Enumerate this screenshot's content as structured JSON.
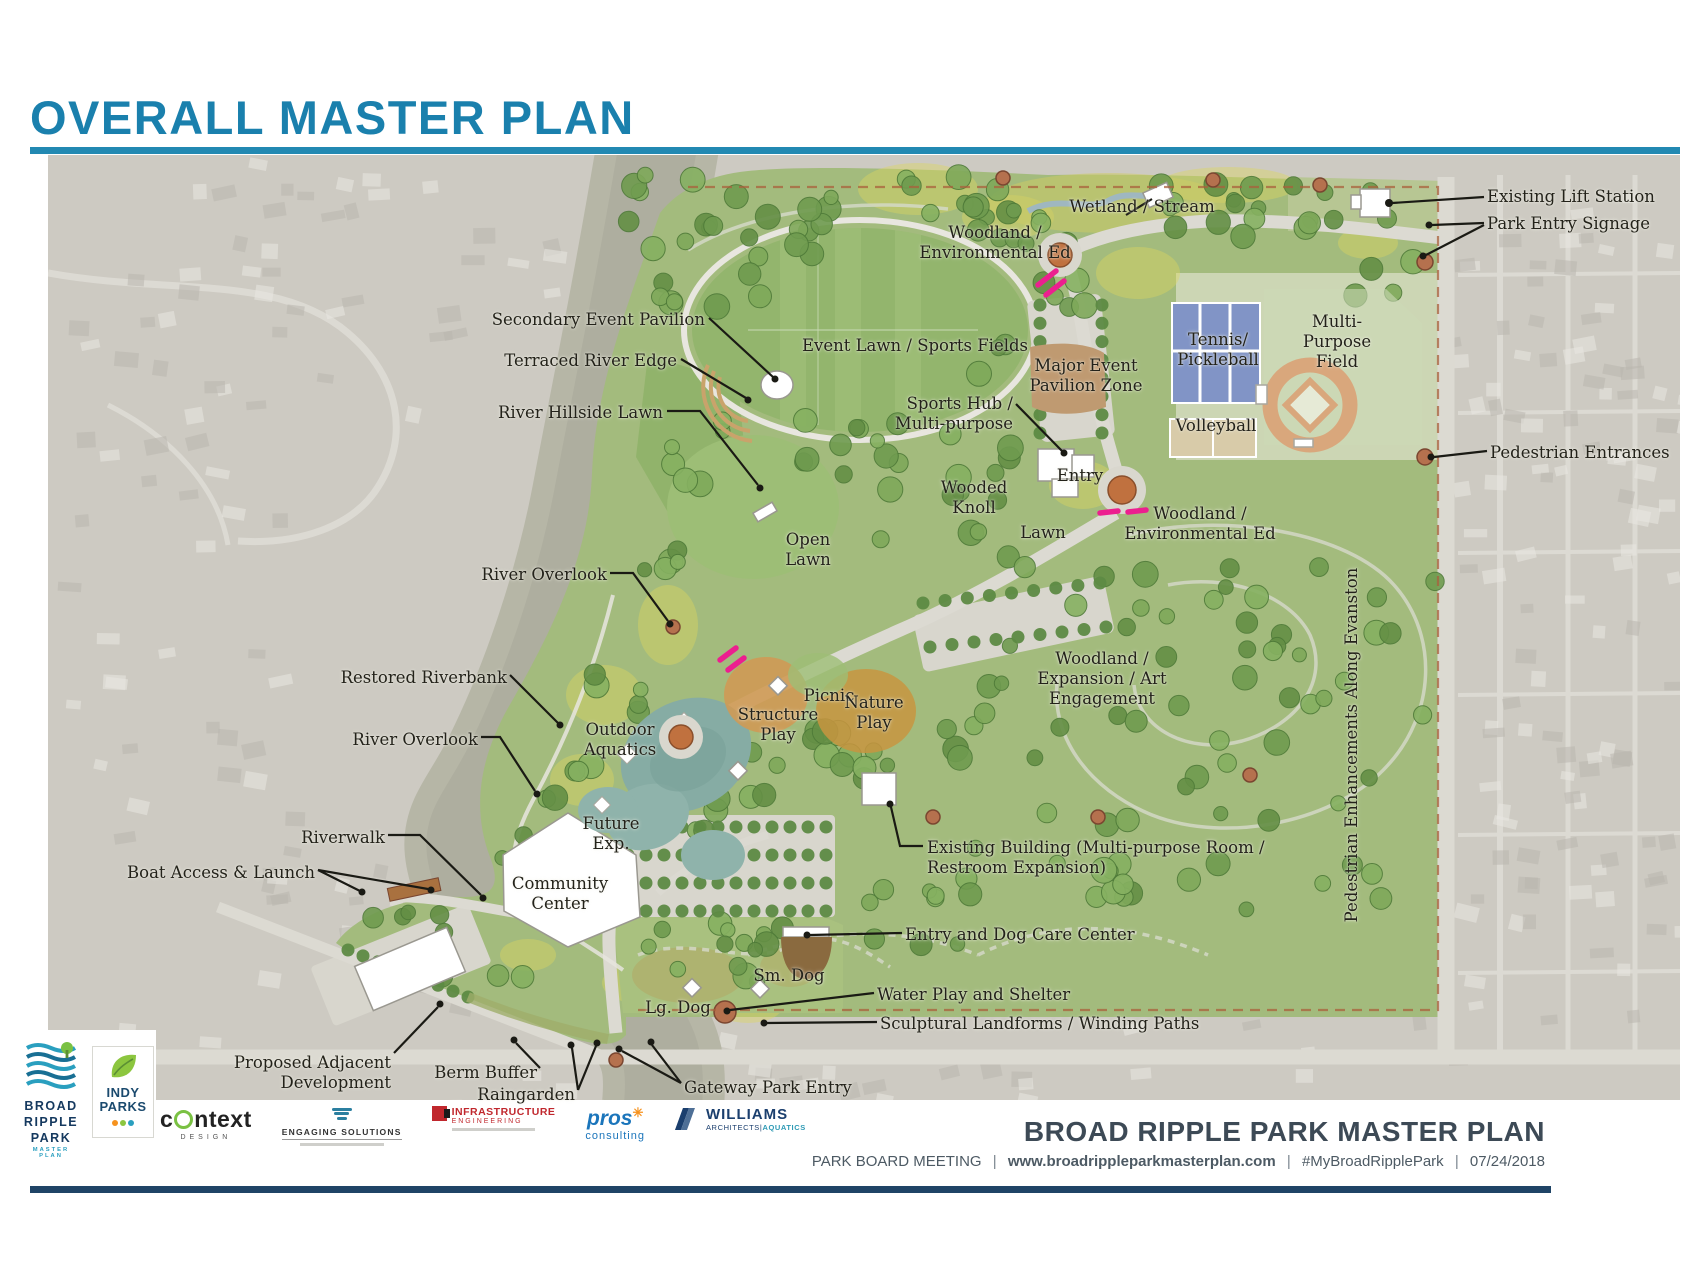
{
  "page": {
    "title": "OVERALL MASTER PLAN"
  },
  "colors": {
    "title": "#1a80ad",
    "rule": "#2289b2",
    "footer_navy": "#1f4466",
    "label_ink": "#23221a",
    "gateway_magenta": "#ec1f8f",
    "park_green": "#a3bb7d",
    "river_gray_green": "#b6b6a6",
    "entry_node_rust": "#b5714e",
    "court_blue": "#8194c6"
  },
  "map": {
    "labels": [
      {
        "id": "existing-lift-station",
        "text": "Existing Lift Station",
        "x": 1439,
        "y": 32,
        "align": "left"
      },
      {
        "id": "park-entry-signage",
        "text": "Park Entry Signage",
        "x": 1439,
        "y": 59,
        "align": "left"
      },
      {
        "id": "wetland-stream",
        "text": "Wetland / Stream",
        "x": 1094,
        "y": 42,
        "align": "center"
      },
      {
        "id": "woodland-env-ed-north",
        "text": "Woodland /\nEnvironmental Ed",
        "x": 947,
        "y": 68,
        "align": "center"
      },
      {
        "id": "secondary-event-pavilion",
        "text": "Secondary Event Pavilion",
        "x": 657,
        "y": 155,
        "align": "right"
      },
      {
        "id": "terraced-river-edge",
        "text": "Terraced River Edge",
        "x": 629,
        "y": 196,
        "align": "right"
      },
      {
        "id": "river-hillside-lawn",
        "text": "River Hillside Lawn",
        "x": 615,
        "y": 248,
        "align": "right"
      },
      {
        "id": "event-lawn-sports-fields",
        "text": "Event Lawn / Sports Fields",
        "x": 867,
        "y": 181,
        "align": "center"
      },
      {
        "id": "major-event-pavilion-zone",
        "text": "Major Event\nPavilion Zone",
        "x": 1038,
        "y": 201,
        "align": "center"
      },
      {
        "id": "sports-hub",
        "text": "Sports Hub /\nMulti-purpose",
        "x": 965,
        "y": 239,
        "align": "right"
      },
      {
        "id": "tennis-pickleball",
        "text": "Tennis/\nPickleball",
        "x": 1170,
        "y": 175,
        "align": "center"
      },
      {
        "id": "volleyball",
        "text": "Volleyball",
        "x": 1168,
        "y": 261,
        "align": "center"
      },
      {
        "id": "multi-purpose-field",
        "text": "Multi-\nPurpose\nField",
        "x": 1289,
        "y": 157,
        "align": "center"
      },
      {
        "id": "entry",
        "text": "Entry",
        "x": 1032,
        "y": 311,
        "align": "center"
      },
      {
        "id": "wooded-knoll",
        "text": "Wooded\nKnoll",
        "x": 926,
        "y": 323,
        "align": "center"
      },
      {
        "id": "lawn",
        "text": "Lawn",
        "x": 995,
        "y": 368,
        "align": "center"
      },
      {
        "id": "woodland-env-ed-east",
        "text": "Woodland /\nEnvironmental Ed",
        "x": 1152,
        "y": 349,
        "align": "center"
      },
      {
        "id": "pedestrian-entrances",
        "text": "Pedestrian Entrances",
        "x": 1442,
        "y": 288,
        "align": "left"
      },
      {
        "id": "river-overlook-north",
        "text": "River Overlook",
        "x": 559,
        "y": 410,
        "align": "right"
      },
      {
        "id": "open-lawn",
        "text": "Open\nLawn",
        "x": 760,
        "y": 375,
        "align": "center"
      },
      {
        "id": "restored-riverbank",
        "text": "Restored Riverbank",
        "x": 459,
        "y": 513,
        "align": "right"
      },
      {
        "id": "river-overlook-south",
        "text": "River Overlook",
        "x": 430,
        "y": 575,
        "align": "right"
      },
      {
        "id": "outdoor-aquatics",
        "text": "Outdoor\nAquatics",
        "x": 572,
        "y": 565,
        "align": "center"
      },
      {
        "id": "structure-play",
        "text": "Structure\nPlay",
        "x": 730,
        "y": 550,
        "align": "center"
      },
      {
        "id": "picnic",
        "text": "Picnic",
        "x": 781,
        "y": 531,
        "align": "center"
      },
      {
        "id": "nature-play",
        "text": "Nature\nPlay",
        "x": 826,
        "y": 538,
        "align": "center"
      },
      {
        "id": "woodland-expansion-art",
        "text": "Woodland /\nExpansion / Art\nEngagement",
        "x": 1054,
        "y": 494,
        "align": "center"
      },
      {
        "id": "riverwalk",
        "text": "Riverwalk",
        "x": 337,
        "y": 673,
        "align": "right"
      },
      {
        "id": "boat-access-launch",
        "text": "Boat Access & Launch",
        "x": 267,
        "y": 708,
        "align": "right"
      },
      {
        "id": "community-center",
        "text": "Community\nCenter",
        "x": 512,
        "y": 719,
        "align": "center"
      },
      {
        "id": "future-exp",
        "text": "Future\nExp.",
        "x": 563,
        "y": 659,
        "align": "center"
      },
      {
        "id": "existing-building",
        "text": "Existing Building (Multi-purpose Room /\nRestroom Expansion)",
        "x": 879,
        "y": 683,
        "align": "left"
      },
      {
        "id": "entry-dog-care",
        "text": "Entry and Dog Care Center",
        "x": 857,
        "y": 770,
        "align": "left"
      },
      {
        "id": "sm-dog",
        "text": "Sm. Dog",
        "x": 741,
        "y": 811,
        "align": "center"
      },
      {
        "id": "lg-dog",
        "text": "Lg. Dog",
        "x": 630,
        "y": 843,
        "align": "center"
      },
      {
        "id": "water-play-shelter",
        "text": "Water Play and Shelter",
        "x": 829,
        "y": 830,
        "align": "left"
      },
      {
        "id": "sculptural-landforms",
        "text": "Sculptural Landforms / Winding Paths",
        "x": 832,
        "y": 859,
        "align": "left"
      },
      {
        "id": "proposed-adjacent-development",
        "text": "Proposed Adjacent\nDevelopment",
        "x": 343,
        "y": 898,
        "align": "right"
      },
      {
        "id": "berm-buffer",
        "text": "Berm Buffer",
        "x": 489,
        "y": 908,
        "align": "right"
      },
      {
        "id": "raingarden",
        "text": "Raingarden",
        "x": 527,
        "y": 930,
        "align": "right"
      },
      {
        "id": "gateway-park-entry",
        "text": "Gateway Park Entry",
        "x": 636,
        "y": 923,
        "align": "left"
      },
      {
        "id": "pedestrian-enhancements-evanston",
        "text": "Pedestrian Enhancements Along Evanston",
        "x": 1304,
        "y": 590,
        "align": "vertical"
      }
    ]
  },
  "footer": {
    "org": {
      "brp_lines": [
        "BROAD",
        "RIPPLE",
        "PARK"
      ],
      "brp_sub": "MASTER PLAN",
      "indy_lines": [
        "INDY",
        "PARKS"
      ]
    },
    "partners": {
      "context": {
        "pre": "c",
        "post": "ntext",
        "sub": "DESIGN"
      },
      "engaging": {
        "name": "ENGAGING SOLUTIONS"
      },
      "infrastructure": {
        "name": "INFRASTRUCTURE",
        "sub": "ENGINEERING"
      },
      "pros": {
        "name": "pros",
        "sub": "consulting"
      },
      "williams": {
        "name": "WILLIAMS",
        "sub": "ARCHITECTS",
        "sub2": "AQUATICS"
      }
    },
    "plan_title": "BROAD RIPPLE PARK MASTER PLAN",
    "meeting": "PARK BOARD MEETING",
    "url": "www.broadrippleparkmasterplan.com",
    "hashtag": "#MyBroadRipplePark",
    "date": "07/24/2018",
    "separator": "|"
  }
}
